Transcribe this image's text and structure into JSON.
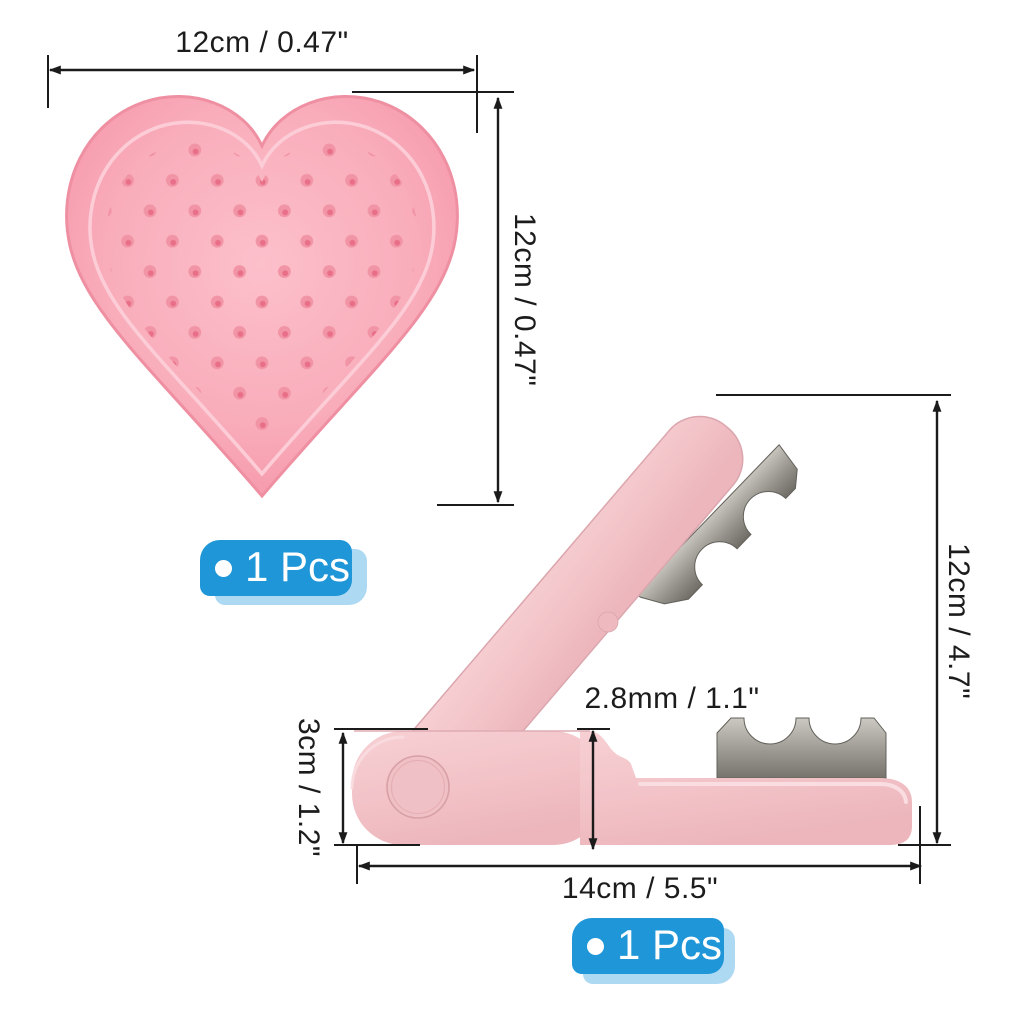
{
  "heart_pad": {
    "badge_label": "1 Pcs",
    "width_label": "12cm / 0.47\"",
    "height_label": "12cm / 0.47\""
  },
  "trimmer": {
    "badge_label": "1 Pcs",
    "height_label": "12cm / 4.7\"",
    "gap_label": "2.8mm / 1.1\"",
    "side_label": "3cm / 1.2\"",
    "length_label": "14cm / 5.5\""
  },
  "colors": {
    "badge_blue": "#1e96d8",
    "badge_light_blue": "#aed9f3",
    "heart_pink": "#f9adbb",
    "heart_bump_pink": "#ef8398",
    "body_pink": "#f2c3c8",
    "blade_gray": "#908e86",
    "dimension_line": "#1b1b1b"
  }
}
